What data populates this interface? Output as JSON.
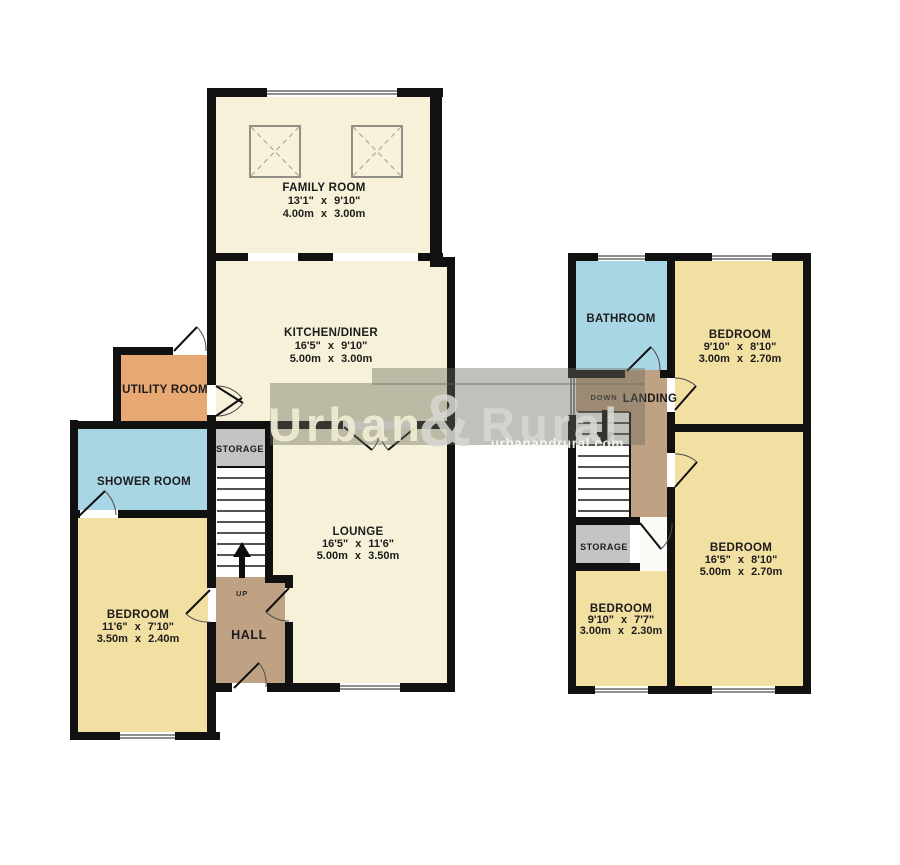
{
  "page": {
    "width": 900,
    "height": 865,
    "background": "#ffffff"
  },
  "palette": {
    "wall": "#111111",
    "floor_cream": "#f6f1d8",
    "floor_yellow": "#f2dfa2",
    "floor_blue": "#a9d6e4",
    "floor_orange": "#e8a873",
    "floor_brown": "#bfa183",
    "floor_gray": "#c5c4c2",
    "watermark_gray": "#6c6c60"
  },
  "watermark": {
    "urban": "Urban",
    "amp": "&",
    "rural": "Rural",
    "site": "urbanandrural.com"
  },
  "ground_floor": {
    "family_room": {
      "name": "FAMILY ROOM",
      "size_imperial": "13'1\" x 9'10\"",
      "size_metric": "4.00m x 3.00m"
    },
    "kitchen_diner": {
      "name": "KITCHEN/DINER",
      "size_imperial": "16'5\" x 9'10\"",
      "size_metric": "5.00m x 3.00m"
    },
    "utility_room": {
      "name": "UTILITY ROOM"
    },
    "shower_room": {
      "name": "SHOWER ROOM"
    },
    "storage": {
      "name": "STORAGE"
    },
    "lounge": {
      "name": "LOUNGE",
      "size_imperial": "16'5\" x 11'6\"",
      "size_metric": "5.00m x 3.50m"
    },
    "bedroom": {
      "name": "BEDROOM",
      "size_imperial": "11'6\" x 7'10\"",
      "size_metric": "3.50m x 2.40m"
    },
    "hall": {
      "name": "HALL"
    },
    "stairs_label": "UP"
  },
  "first_floor": {
    "bathroom": {
      "name": "BATHROOM"
    },
    "bedroom_front": {
      "name": "BEDROOM",
      "size_imperial": "9'10\" x 8'10\"",
      "size_metric": "3.00m x 2.70m"
    },
    "landing": {
      "name": "LANDING"
    },
    "stairs_label": "DOWN",
    "storage": {
      "name": "STORAGE"
    },
    "bedroom_small": {
      "name": "BEDROOM",
      "size_imperial": "9'10\" x 7'7\"",
      "size_metric": "3.00m x 2.30m"
    },
    "bedroom_rear": {
      "name": "BEDROOM",
      "size_imperial": "16'5\" x 8'10\"",
      "size_metric": "5.00m x 2.70m"
    }
  }
}
